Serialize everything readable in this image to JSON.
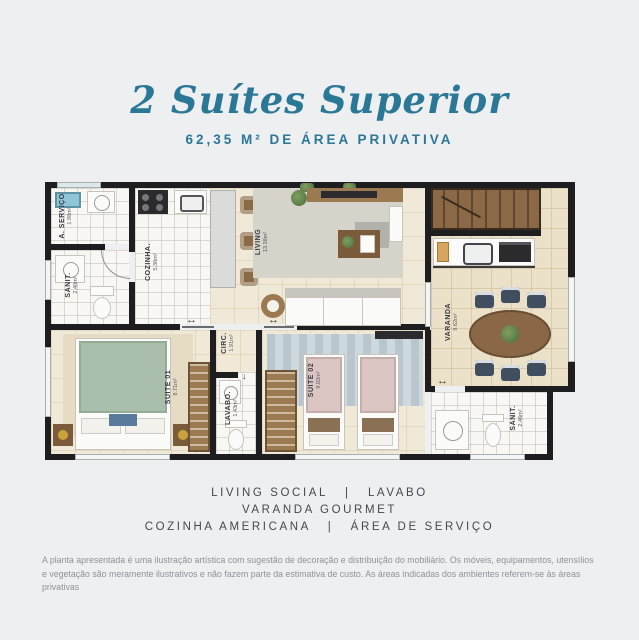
{
  "page": {
    "background": "#edeff1"
  },
  "header": {
    "title": "2 Suítes Superior",
    "subtitle": "62,35 M² DE ÁREA PRIVATIVA",
    "accent_color": "#2b7796"
  },
  "floorplan": {
    "wall_color": "#1e1e21",
    "icons": {
      "sliding_door": "↔",
      "door_down": "↓"
    },
    "rooms": [
      {
        "id": "servico",
        "label": "A. SERVIÇO",
        "area": "1.98m²"
      },
      {
        "id": "sanit_1",
        "label": "SANIT.",
        "area": "2.40m²"
      },
      {
        "id": "cozinha",
        "label": "COZINHA.",
        "area": "5.36m²"
      },
      {
        "id": "living",
        "label": "LIVING",
        "area": "13.38m²"
      },
      {
        "id": "varanda",
        "label": "VARANDA",
        "area": "9.62m²"
      },
      {
        "id": "suite_01",
        "label": "SUITE 01",
        "area": "8.71m²"
      },
      {
        "id": "circ",
        "label": "CIRC.",
        "area": "1.91m²"
      },
      {
        "id": "lavabo",
        "label": "LAVABO.",
        "area": "1.43m²"
      },
      {
        "id": "suite_02",
        "label": "SUITE 02",
        "area": "9.02m²"
      },
      {
        "id": "sanit_2",
        "label": "SANIT.",
        "area": "2.46m²"
      }
    ]
  },
  "features": {
    "line1": "LIVING SOCIAL   |   LAVABO",
    "line2": "VARANDA GOURMET",
    "line3": "COZINHA AMERICANA   |   ÁREA DE SERVIÇO"
  },
  "disclaimer": "A planta apresentada é uma ilustração artística com sugestão de decoração e distribuição do mobiliário. Os móveis, equipamentos, utensílios e vegetação são meramente ilustrativos e não fazem parte da estimativa de custo. As áreas indicadas dos ambientes referem-se às áreas privativas"
}
